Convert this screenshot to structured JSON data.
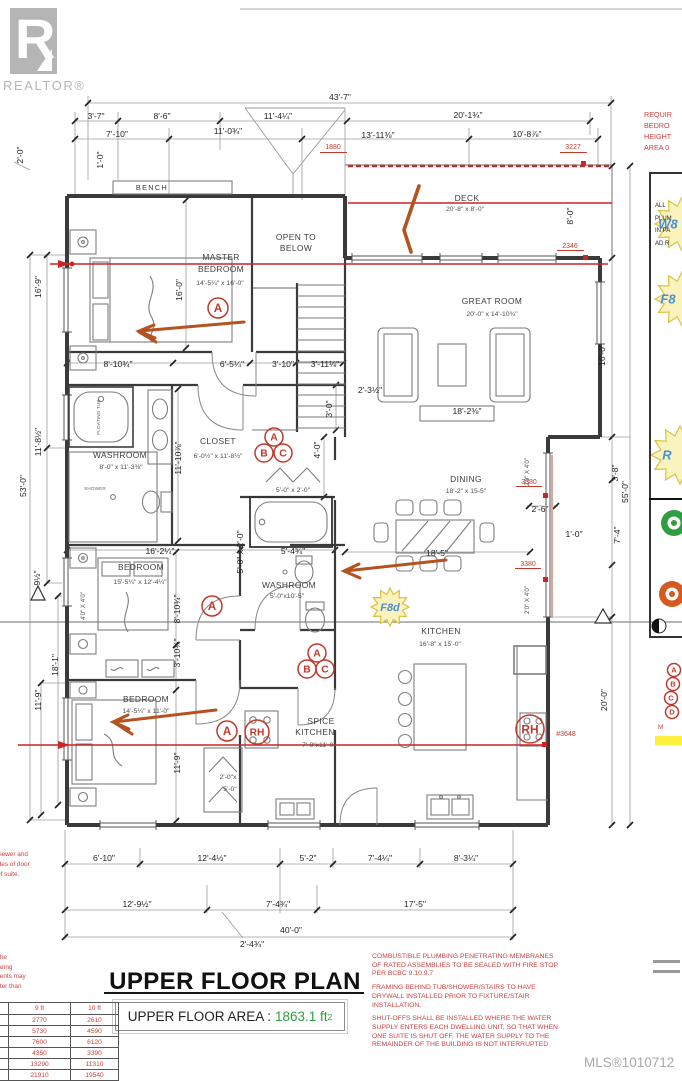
{
  "colors": {
    "annotation_red": "#c0392b",
    "line_red": "#cc2525",
    "arrow_orange": "#b4531f",
    "star_fill": "#fbf3bd",
    "star_stroke": "#d9c23f",
    "star_text": "#4a8fd4",
    "area_green": "#2e9e3e",
    "tag_green": "#2f9e41",
    "tag_orange": "#d65a1f",
    "highlight_yellow": "#ffef3e"
  },
  "branding": {
    "logo_letter": "R",
    "logo_name": "REALTOR®"
  },
  "sheet": {
    "title": "UPPER FLOOR PLAN",
    "area_label": "UPPER FLOOR AREA :",
    "area_value": "1863.1 ft",
    "area_exp": "2",
    "mls": "MLS®1010712"
  },
  "notes": {
    "right": [
      "COMBUSTIBLE PLUMBING PENETRATING MEMBRANES OF RATED ASSEMBLIES TO BE SEALED WITH FIRE STOP PER BCBC 9.10.9.7",
      "FRAMING BEHIND TUB/SHOWER/STAIRS TO HAVE DRYWALL INSTALLED PRIOR TO FIXTURE/STAIR INSTALLATION.",
      "SHUT-OFFS SHALL BE INSTALLED WHERE THE WATER SUPPLY ENTERS EACH DWELLING UNIT, SO THAT WHEN ONE SUITE IS SHUT OFF, THE WATER SUPPLY TO THE REMAINDER OF THE BUILDING IS NOT INTERRUPTED"
    ],
    "left_clipped": [
      "gh to the foundation, the",
      "convenience only.  Bearing",
      "manufacturers documents may",
      "d.  Any point load greater than",
      "num 2 ply post."
    ],
    "door_clipped": [
      "oor viewer and",
      "th sides of door",
      "oor of suite."
    ],
    "panel_header_clipped": [
      "REQUIR",
      "BEDRO",
      "HEIGHT",
      "AREA 0"
    ],
    "panel_box_clipped": [
      "ALL",
      "PLUM",
      "IN PA",
      "AD R"
    ],
    "panel_note_clipped": "M"
  },
  "load_table": {
    "headers": [
      "9 ft",
      "10 ft"
    ],
    "rows": [
      [
        "2770",
        "2610"
      ],
      [
        "5730",
        "4590"
      ],
      [
        "7600",
        "6120"
      ],
      [
        "4350",
        "3390"
      ],
      [
        "13290",
        "11310"
      ],
      [
        "21910",
        "19540"
      ]
    ]
  },
  "plan": {
    "labels": [
      {
        "t": "BENCH",
        "x": 152,
        "y": 190,
        "c": "tiny2"
      },
      {
        "t": "OPEN TO",
        "x": 296,
        "y": 240,
        "c": "room"
      },
      {
        "t": "BELOW",
        "x": 296,
        "y": 251,
        "c": "room"
      },
      {
        "t": "MASTER",
        "x": 221,
        "y": 260,
        "c": "room"
      },
      {
        "t": "BEDROOM",
        "x": 221,
        "y": 272,
        "c": "room"
      },
      {
        "t": "14'-5¼\" x 16'-0\"",
        "x": 220,
        "y": 285,
        "c": "size"
      },
      {
        "t": "DECK",
        "x": 467,
        "y": 201,
        "c": "room"
      },
      {
        "t": "20'-8\" x 8'-0\"",
        "x": 465,
        "y": 211,
        "c": "size"
      },
      {
        "t": "GREAT ROOM",
        "x": 492,
        "y": 304,
        "c": "room"
      },
      {
        "t": "20'-0\" x 14'-10¾\"",
        "x": 492,
        "y": 316,
        "c": "size"
      },
      {
        "t": "WASHROOM",
        "x": 120,
        "y": 458,
        "c": "room"
      },
      {
        "t": "8'-0\" x 11'-3⅜\"",
        "x": 121,
        "y": 469,
        "c": "size"
      },
      {
        "t": "SHOWER",
        "x": 95,
        "y": 490,
        "c": "micro"
      },
      {
        "t": "CLOSET",
        "x": 218,
        "y": 444,
        "c": "room"
      },
      {
        "t": "6'-0½\" x 11'-8½\"",
        "x": 218,
        "y": 458,
        "c": "size"
      },
      {
        "t": "BEDROOM",
        "x": 141,
        "y": 570,
        "c": "room"
      },
      {
        "t": "15'-5¼\" x 12'-4¼\"",
        "x": 140,
        "y": 584,
        "c": "size"
      },
      {
        "t": "DINING",
        "x": 466,
        "y": 482,
        "c": "room"
      },
      {
        "t": "18'-2\" x 15-5\"",
        "x": 466,
        "y": 493,
        "c": "size"
      },
      {
        "t": "WASHROOM",
        "x": 289,
        "y": 588,
        "c": "room"
      },
      {
        "t": "5'-0\"x10'-5\"",
        "x": 287,
        "y": 598,
        "c": "size"
      },
      {
        "t": "KITCHEN",
        "x": 441,
        "y": 634,
        "c": "room"
      },
      {
        "t": "16'-8\" x 15'-0\"",
        "x": 440,
        "y": 646,
        "c": "size"
      },
      {
        "t": "BEDROOM",
        "x": 146,
        "y": 702,
        "c": "room"
      },
      {
        "t": "14'-5¼\" x 11'-0\"",
        "x": 146,
        "y": 713,
        "c": "size"
      },
      {
        "t": "SPICE",
        "x": 321,
        "y": 724,
        "c": "room"
      },
      {
        "t": "KITCHEN",
        "x": 315,
        "y": 735,
        "c": "room"
      },
      {
        "t": "7'-0\"x11'-0\"",
        "x": 319,
        "y": 747,
        "c": "size"
      },
      {
        "t": "5'-0\" x 2'-0\"",
        "x": 293,
        "y": 492,
        "c": "size"
      },
      {
        "t": "2'-0\"x",
        "x": 228,
        "y": 779,
        "c": "size"
      },
      {
        "t": "5'-0\"",
        "x": 230,
        "y": 791,
        "c": "size"
      },
      {
        "t": "FLOATING TUB",
        "x": 100,
        "y": 417,
        "c": "micro",
        "r": -90
      },
      {
        "t": "43'-7\"",
        "x": 340,
        "y": 100,
        "c": "dim"
      },
      {
        "t": "3'-7\"",
        "x": 96,
        "y": 119,
        "c": "dim"
      },
      {
        "t": "8'-6\"",
        "x": 162,
        "y": 119,
        "c": "dim"
      },
      {
        "t": "11'-4¼\"",
        "x": 278,
        "y": 119,
        "c": "dim"
      },
      {
        "t": "20'-1¾\"",
        "x": 468,
        "y": 118,
        "c": "dim"
      },
      {
        "t": "7'-10\"",
        "x": 117,
        "y": 137,
        "c": "dim"
      },
      {
        "t": "11'-0¾\"",
        "x": 228,
        "y": 134,
        "c": "dim"
      },
      {
        "t": "13'-11⅜\"",
        "x": 378,
        "y": 138,
        "c": "dim"
      },
      {
        "t": "10'-8⅞\"",
        "x": 527,
        "y": 137,
        "c": "dim"
      },
      {
        "t": "8'-10¾\"",
        "x": 118,
        "y": 367,
        "c": "dim"
      },
      {
        "t": "6'-5¼\"",
        "x": 232,
        "y": 367,
        "c": "dim"
      },
      {
        "t": "3'-10\"",
        "x": 283,
        "y": 367,
        "c": "dim"
      },
      {
        "t": "3'-11⅛\"",
        "x": 325,
        "y": 367,
        "c": "dim"
      },
      {
        "t": "2'-3½\"",
        "x": 370,
        "y": 393,
        "c": "dim"
      },
      {
        "t": "18'-2⅜\"",
        "x": 467,
        "y": 414,
        "c": "dim"
      },
      {
        "t": "16'-2¼\"",
        "x": 160,
        "y": 554,
        "c": "dim"
      },
      {
        "t": "5'-4¾\"",
        "x": 293,
        "y": 554,
        "c": "dim"
      },
      {
        "t": "18'-5\"",
        "x": 437,
        "y": 556,
        "c": "dim"
      },
      {
        "t": "2'-6\"",
        "x": 540,
        "y": 512,
        "c": "dim"
      },
      {
        "t": "1'-0\"",
        "x": 574,
        "y": 537,
        "c": "dim"
      },
      {
        "t": "6'-10\"",
        "x": 104,
        "y": 861,
        "c": "dim"
      },
      {
        "t": "12'-4½\"",
        "x": 212,
        "y": 861,
        "c": "dim"
      },
      {
        "t": "5'-2\"",
        "x": 308,
        "y": 861,
        "c": "dim"
      },
      {
        "t": "7'-4¼\"",
        "x": 380,
        "y": 861,
        "c": "dim"
      },
      {
        "t": "8'-3¼\"",
        "x": 466,
        "y": 861,
        "c": "dim"
      },
      {
        "t": "12'-9½\"",
        "x": 137,
        "y": 907,
        "c": "dim"
      },
      {
        "t": "7'-4¾\"",
        "x": 278,
        "y": 907,
        "c": "dim"
      },
      {
        "t": "17'-5\"",
        "x": 415,
        "y": 907,
        "c": "dim"
      },
      {
        "t": "40'-0\"",
        "x": 291,
        "y": 933,
        "c": "dim"
      },
      {
        "t": "2'-4¾\"",
        "x": 252,
        "y": 947,
        "c": "dim"
      },
      {
        "t": "2'-0\"",
        "x": 23,
        "y": 155,
        "c": "dim",
        "r": -90
      },
      {
        "t": "1'-0\"",
        "x": 103,
        "y": 160,
        "c": "dim",
        "r": -90
      },
      {
        "t": "16'-9\"",
        "x": 41,
        "y": 287,
        "c": "dim",
        "r": -90
      },
      {
        "t": "11'-8½\"",
        "x": 41,
        "y": 442,
        "c": "dim",
        "r": -90
      },
      {
        "t": "53'-0\"",
        "x": 26,
        "y": 486,
        "c": "dim",
        "r": -90
      },
      {
        "t": "9½\"",
        "x": 40,
        "y": 578,
        "c": "dim",
        "r": -90
      },
      {
        "t": "18'-1\"",
        "x": 58,
        "y": 665,
        "c": "dim",
        "r": -90
      },
      {
        "t": "11'-9\"",
        "x": 41,
        "y": 700,
        "c": "dim",
        "r": -90
      },
      {
        "t": "16'-0\"",
        "x": 182,
        "y": 290,
        "c": "dim",
        "r": -90
      },
      {
        "t": "11'-10⅞\"",
        "x": 181,
        "y": 458,
        "c": "dim",
        "r": -90
      },
      {
        "t": "8'-10¾\"",
        "x": 180,
        "y": 609,
        "c": "dim",
        "r": -90
      },
      {
        "t": "3'-10¾\"",
        "x": 180,
        "y": 653,
        "c": "dim",
        "r": -90
      },
      {
        "t": "11'-9\"",
        "x": 180,
        "y": 763,
        "c": "dim",
        "r": -90
      },
      {
        "t": "4'-0\"",
        "x": 320,
        "y": 450,
        "c": "dim",
        "r": -90
      },
      {
        "t": "3'-0\"",
        "x": 332,
        "y": 409,
        "c": "dim",
        "r": -90
      },
      {
        "t": "5'-0\" x 2'-0\"",
        "x": 243,
        "y": 552,
        "c": "dim",
        "r": -90
      },
      {
        "t": "8'-0\"",
        "x": 573,
        "y": 216,
        "c": "dim",
        "r": -90
      },
      {
        "t": "16'-0\"",
        "x": 605,
        "y": 355,
        "c": "dim",
        "r": -90
      },
      {
        "t": "3'-8\"",
        "x": 618,
        "y": 473,
        "c": "dim",
        "r": -90
      },
      {
        "t": "55'-0\"",
        "x": 628,
        "y": 492,
        "c": "dim",
        "r": -90
      },
      {
        "t": "7'-4\"",
        "x": 620,
        "y": 535,
        "c": "dim",
        "r": -90
      },
      {
        "t": "20'-0\"",
        "x": 607,
        "y": 700,
        "c": "dim",
        "r": -90
      },
      {
        "t": "2'0\" X 4'0\"",
        "x": 529,
        "y": 472,
        "c": "win",
        "r": -90
      },
      {
        "t": "2'0\" X 4'0\"",
        "x": 529,
        "y": 600,
        "c": "win",
        "r": -90
      },
      {
        "t": "4'0\" X 4'0\"",
        "x": 85,
        "y": 606,
        "c": "win",
        "r": -90
      },
      {
        "t": "1880",
        "x": 333,
        "y": 149,
        "c": "red"
      },
      {
        "t": "3227",
        "x": 573,
        "y": 149,
        "c": "red"
      },
      {
        "t": "2346",
        "x": 570,
        "y": 248,
        "c": "red"
      },
      {
        "t": "3380",
        "x": 529,
        "y": 484,
        "c": "red"
      },
      {
        "t": "3380",
        "x": 528,
        "y": 566,
        "c": "red"
      },
      {
        "t": "#3648",
        "x": 566,
        "y": 736,
        "c": "red"
      }
    ],
    "circles": [
      {
        "t": "A",
        "x": 218,
        "y": 308,
        "r": 10
      },
      {
        "t": "A",
        "x": 274,
        "y": 437,
        "r": 9
      },
      {
        "t": "B",
        "x": 264,
        "y": 453,
        "r": 9
      },
      {
        "t": "C",
        "x": 283,
        "y": 453,
        "r": 9
      },
      {
        "t": "A",
        "x": 212,
        "y": 606,
        "r": 10
      },
      {
        "t": "A",
        "x": 317,
        "y": 653,
        "r": 9
      },
      {
        "t": "B",
        "x": 307,
        "y": 669,
        "r": 9
      },
      {
        "t": "C",
        "x": 325,
        "y": 669,
        "r": 9
      },
      {
        "t": "A",
        "x": 227,
        "y": 731,
        "r": 10
      },
      {
        "t": "RH",
        "x": 257,
        "y": 732,
        "r": 12
      },
      {
        "t": "RH",
        "x": 530,
        "y": 729,
        "r": 14
      },
      {
        "t": "A",
        "x": 674,
        "y": 670,
        "r": 6.5
      },
      {
        "t": "B",
        "x": 673,
        "y": 684,
        "r": 6.5
      },
      {
        "t": "C",
        "x": 671,
        "y": 698,
        "r": 6.5
      },
      {
        "t": "D",
        "x": 672,
        "y": 712,
        "r": 6.5
      }
    ],
    "stars": [
      {
        "t": "F8d",
        "x": 390,
        "y": 607,
        "r": 19
      },
      {
        "t": "W8",
        "x": 682,
        "tx": 668,
        "y": 224,
        "r": 27
      },
      {
        "t": "F8",
        "x": 682,
        "tx": 668,
        "y": 299,
        "r": 27
      },
      {
        "t": "R",
        "x": 680,
        "tx": 667,
        "y": 455,
        "r": 29
      }
    ]
  }
}
